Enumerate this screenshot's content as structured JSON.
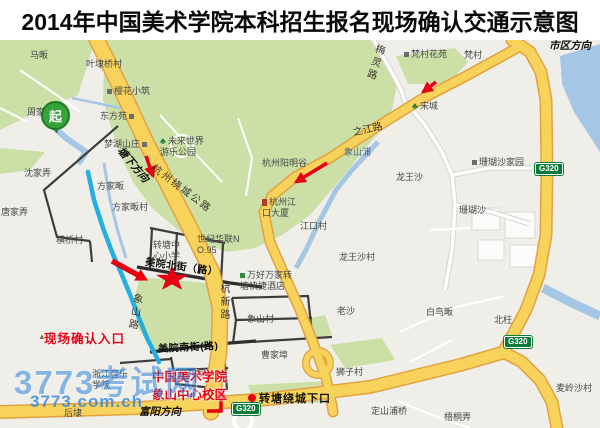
{
  "title": "2014年中国美术学院本科招生报名现场确认交通示意图",
  "watermark": {
    "brand": "3773考试网",
    "url": "3773.com.ch"
  },
  "marker_start": "起",
  "shield_g320": "G320",
  "annotations": {
    "entrance_label": "现场确认入口",
    "campus_name": "中国美术学院\n象山中心校区"
  },
  "colors": {
    "annotation_red": "#e60012",
    "route_cyan": "#25aee0",
    "road_yellow": "#f7d35b",
    "road_yellow_casing": "#e2a23f",
    "park_green": "#cbdfa6",
    "water_blue": "#a6c6e6",
    "shield_green": "#0b7a3b",
    "watermark_blue": "#2f86e0"
  },
  "labels": [
    {
      "id": "mafan",
      "t": "马畈",
      "x": 30,
      "y": 50,
      "c": "pl"
    },
    {
      "id": "yedaiqiaocun",
      "t": "叶埭桥村",
      "x": 86,
      "y": 59,
      "c": "pl"
    },
    {
      "id": "yinghuaxiaozhu",
      "t": "樱花小筑",
      "x": 107,
      "y": 86,
      "c": "pl",
      "i": "sq-l"
    },
    {
      "id": "dongfangyuan",
      "t": "东方苑",
      "x": 100,
      "y": 111,
      "c": "pl",
      "i": "sq-r"
    },
    {
      "id": "zhoujiadai",
      "t": "周家埭",
      "x": 27,
      "y": 107,
      "c": "pl"
    },
    {
      "id": "menghushanzhuang",
      "t": "梦湖山庄",
      "x": 104,
      "y": 139,
      "c": "pl",
      "i": "sq-r"
    },
    {
      "id": "weilaishijie",
      "t": "未来世界\n游乐公园",
      "x": 160,
      "y": 136,
      "c": "pl",
      "i": "tr-l"
    },
    {
      "id": "fancunhuayuan",
      "t": "梵村花苑",
      "x": 404,
      "y": 49,
      "c": "pl",
      "i": "sq-l"
    },
    {
      "id": "fancun",
      "t": "梵村",
      "x": 464,
      "y": 50,
      "c": "pl"
    },
    {
      "id": "songcheng",
      "t": "宋城",
      "x": 412,
      "y": 101,
      "c": "pl",
      "i": "tr-l"
    },
    {
      "id": "xiangshanpu",
      "t": "象山浦",
      "x": 344,
      "y": 147,
      "c": "pl wt"
    },
    {
      "id": "yangminggu",
      "t": "杭州阳明谷",
      "x": 262,
      "y": 158,
      "c": "pl"
    },
    {
      "id": "longwangsha",
      "t": "龙王沙",
      "x": 396,
      "y": 172,
      "c": "pl"
    },
    {
      "id": "shanhushajiayuan",
      "t": "珊瑚沙家园",
      "x": 472,
      "y": 157,
      "c": "pl",
      "i": "sq-l"
    },
    {
      "id": "shanhusha",
      "t": "珊瑚沙",
      "x": 459,
      "y": 205,
      "c": "pl"
    },
    {
      "id": "jiangkoudasha",
      "t": "杭州江\n口大厦",
      "x": 262,
      "y": 197,
      "c": "pl",
      "i": "bd-l"
    },
    {
      "id": "jiangkoucun",
      "t": "江口村",
      "x": 300,
      "y": 221,
      "c": "pl"
    },
    {
      "id": "longwangshacun",
      "t": "龙王沙村",
      "x": 339,
      "y": 252,
      "c": "pl"
    },
    {
      "id": "shenjialong",
      "t": "沈家弄",
      "x": 24,
      "y": 168,
      "c": "pl"
    },
    {
      "id": "tangjialong",
      "t": "唐家弄",
      "x": 1,
      "y": 207,
      "c": "pl"
    },
    {
      "id": "fangjiafan",
      "t": "方家畈",
      "x": 97,
      "y": 181,
      "c": "pl"
    },
    {
      "id": "fangjiafancun",
      "t": "方家畈村",
      "x": 112,
      "y": 202,
      "c": "pl"
    },
    {
      "id": "hengqiaocun",
      "t": "横桥村",
      "x": 56,
      "y": 235,
      "c": "pl"
    },
    {
      "id": "zhuantangxiaoxue",
      "t": "转塘中\n心小学",
      "x": 153,
      "y": 240,
      "c": "pl"
    },
    {
      "id": "shijihualian",
      "t": "世纪华联N\nO.95",
      "x": 197,
      "y": 234,
      "c": "pl"
    },
    {
      "id": "wanhaowanjia",
      "t": "万好万家转\n塘快捷酒店",
      "x": 240,
      "y": 270,
      "c": "pl",
      "i": "gp-l"
    },
    {
      "id": "xiangshancun",
      "t": "象山村",
      "x": 247,
      "y": 314,
      "c": "pl"
    },
    {
      "id": "xiangshan",
      "t": "象山",
      "x": 38,
      "y": 331,
      "c": "pl",
      "i": "mt-l"
    },
    {
      "id": "caojiabu",
      "t": "曹家埠",
      "x": 261,
      "y": 350,
      "c": "pl"
    },
    {
      "id": "laosha",
      "t": "老沙",
      "x": 337,
      "y": 306,
      "c": "pl"
    },
    {
      "id": "shizicun",
      "t": "狮子村",
      "x": 336,
      "y": 367,
      "c": "pl"
    },
    {
      "id": "bainiaofan",
      "t": "白鸟畈",
      "x": 426,
      "y": 307,
      "c": "pl"
    },
    {
      "id": "beiwang",
      "t": "北枉",
      "x": 494,
      "y": 315,
      "c": "pl"
    },
    {
      "id": "mailingshacun",
      "t": "麦岭沙村",
      "x": 556,
      "y": 383,
      "c": "pl"
    },
    {
      "id": "dingshanpuqiao",
      "t": "定山浦桥",
      "x": 371,
      "y": 406,
      "c": "pl"
    },
    {
      "id": "wutonglong",
      "t": "梧桐弄",
      "x": 444,
      "y": 412,
      "c": "pl"
    },
    {
      "id": "houdai",
      "t": "后埭",
      "x": 64,
      "y": 408,
      "c": "pl"
    },
    {
      "id": "zhengjiafan",
      "t": "郑家畈",
      "x": 177,
      "y": 368,
      "c": "pl"
    },
    {
      "id": "yinyuexueyuan",
      "t": "浙江音乐\n学院",
      "x": 92,
      "y": 369,
      "c": "pl"
    },
    {
      "id": "raochenggonglu",
      "t": "杭州绕城公路",
      "x": 156,
      "y": 163,
      "c": "rd sp",
      "r": 37
    },
    {
      "id": "tangxiafangxiang",
      "t": "塘下方向",
      "x": 124,
      "y": 145,
      "c": "dir",
      "r": 50
    },
    {
      "id": "zhijianglu",
      "t": "之江路",
      "x": 352,
      "y": 128,
      "c": "rd",
      "r": -13
    },
    {
      "id": "meilinglu",
      "t": "梅灵路",
      "x": 374,
      "y": 42,
      "c": "rd v",
      "r": 18
    },
    {
      "id": "hangxinlu",
      "t": "杭新路",
      "x": 217,
      "y": 283,
      "c": "rd v"
    },
    {
      "id": "xiangshanlu",
      "t": "象山路",
      "x": 131,
      "y": 292,
      "c": "rd v",
      "r": 10
    },
    {
      "id": "meiyuanbeijie",
      "t": "美院北街（路）",
      "x": 146,
      "y": 257,
      "c": "st",
      "r": 8
    },
    {
      "id": "meiyuannanjie",
      "t": "美院南街(路)",
      "x": 158,
      "y": 344,
      "c": "st",
      "r": -3
    },
    {
      "id": "shiqufangxiang",
      "t": "市区方向",
      "x": 549,
      "y": 40,
      "c": "dir"
    },
    {
      "id": "fuyangfangxiang",
      "t": "富阳方向",
      "x": 139,
      "y": 406,
      "c": "dir"
    },
    {
      "id": "zhuantangxiakou",
      "t": "转塘绕城下口",
      "x": 259,
      "y": 393,
      "c": "jn"
    }
  ]
}
